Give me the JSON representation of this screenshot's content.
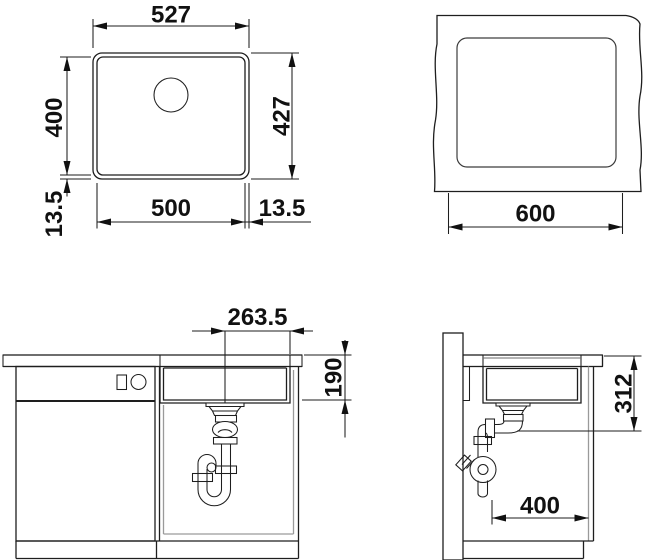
{
  "dims": {
    "plan": {
      "outer_width": "527",
      "inner_height": "400",
      "outer_height": "427",
      "inner_width": "500",
      "rim_left": "13.5",
      "rim_right": "13.5"
    },
    "cutout": {
      "cabinet_width": "600"
    },
    "front": {
      "drain_offset": "263.5",
      "bowl_depth": "190"
    },
    "side": {
      "outlet_height": "312",
      "trap_clearance": "400"
    }
  }
}
